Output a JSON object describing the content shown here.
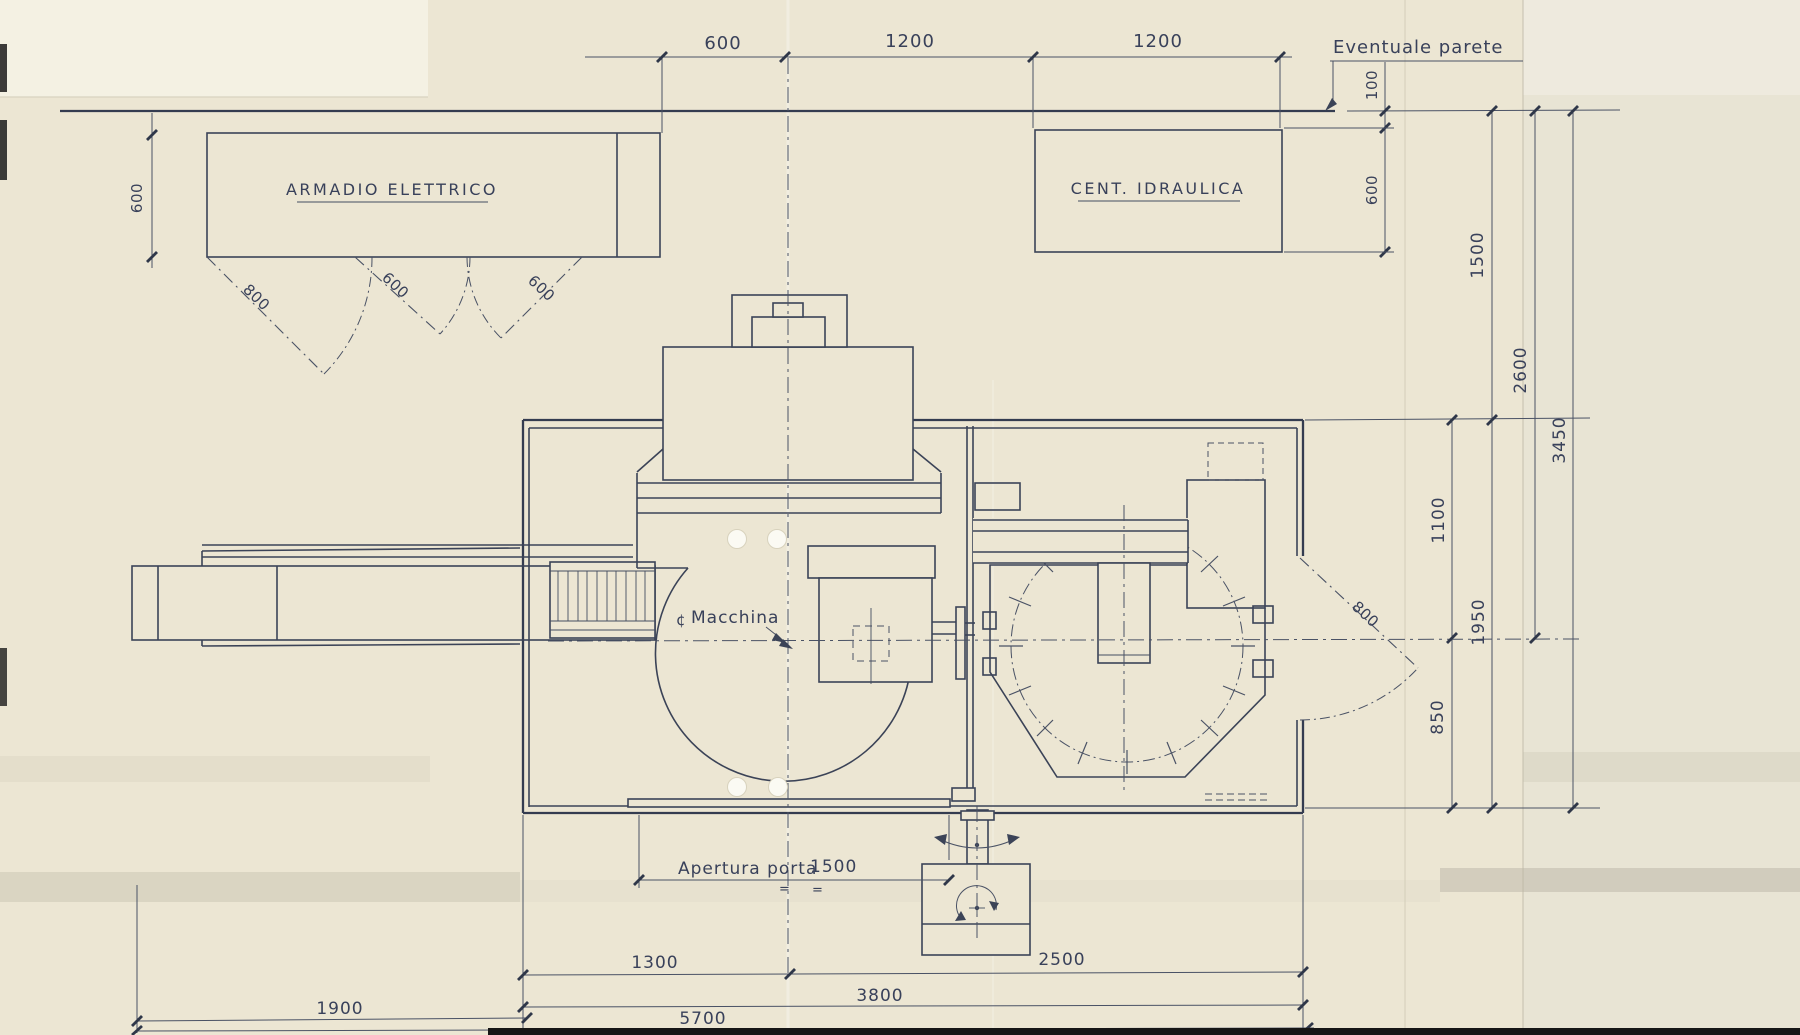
{
  "meta": {
    "drawing_type": "machine installation floor plan (scanned technical drawing)",
    "language": "Italian",
    "units": "mm"
  },
  "palette": {
    "paper": "#ece6d3",
    "paper_bright": "#f4f1e3",
    "paper_right": "#e8e4d4",
    "ink": "#3b4357",
    "scan_edge": "#151515"
  },
  "labels": {
    "armadio": "ARMADIO ELETTRICO",
    "idraulica": "CENT. IDRAULICA",
    "parete": "Eventuale parete",
    "macchina_mark": "¢",
    "macchina": "Macchina",
    "apertura": "Apertura porta",
    "eq": "="
  },
  "dims": {
    "t600": "600",
    "t1200a": "1200",
    "t1200b": "1200",
    "p100": "100",
    "i600": "600",
    "a600": "600",
    "d800": "800",
    "d600a": "600",
    "d600b": "600",
    "r1500": "1500",
    "r2600": "2600",
    "r3450": "3450",
    "r1100": "1100",
    "r1950": "1950",
    "r850": "850",
    "rdoor800": "800",
    "ap1500": "1500",
    "b1300": "1300",
    "b2500": "2500",
    "b3800": "3800",
    "b1900": "1900",
    "b5700": "5700"
  }
}
